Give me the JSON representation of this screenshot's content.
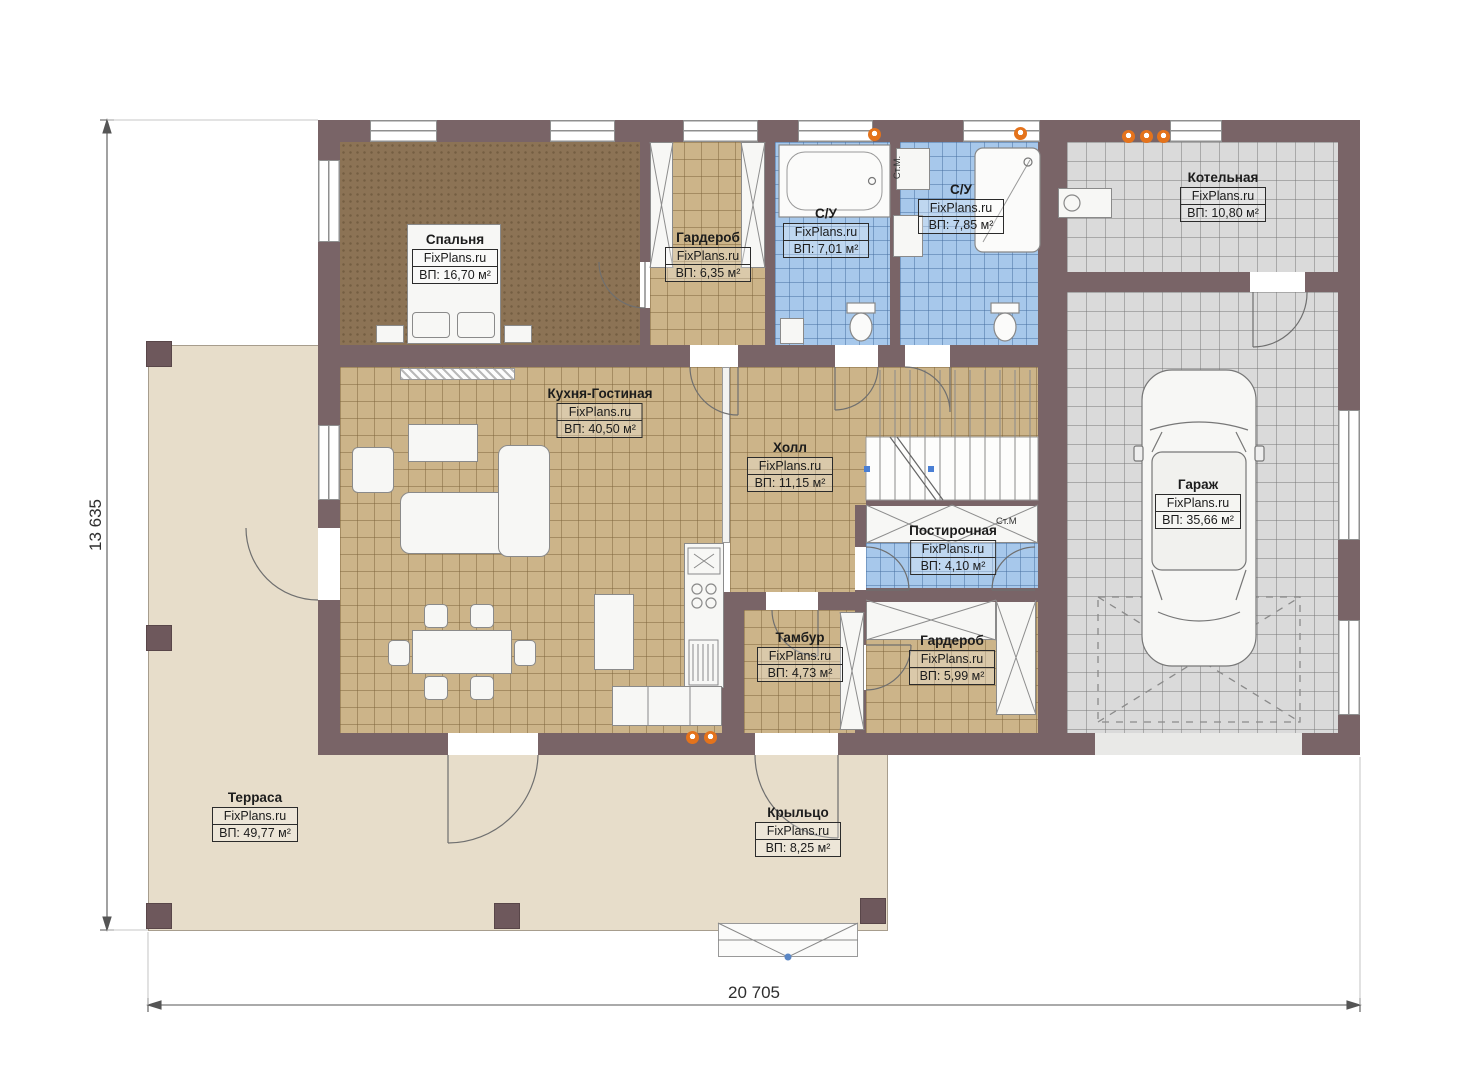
{
  "plan": {
    "brand": "FixPlans.ru",
    "dimensions": {
      "height_label": "13 635",
      "width_label": "20 705"
    },
    "annotations": {
      "washer_vertical": "Ст.М.",
      "washer_laundry": "Ст.М"
    },
    "rooms": [
      {
        "name": "Спальня",
        "area": "ВП: 16,70 м²"
      },
      {
        "name": "Гардероб",
        "area": "ВП: 6,35 м²"
      },
      {
        "name": "С/У",
        "area": "ВП: 7,01 м²"
      },
      {
        "name": "С/У",
        "area": "ВП: 7,85 м²"
      },
      {
        "name": "Котельная",
        "area": "ВП: 10,80 м²"
      },
      {
        "name": "Кухня-Гостиная",
        "area": "ВП: 40,50 м²"
      },
      {
        "name": "Холл",
        "area": "ВП: 11,15 м²"
      },
      {
        "name": "Гараж",
        "area": "ВП: 35,66 м²"
      },
      {
        "name": "Постирочная",
        "area": "ВП: 4,10 м²"
      },
      {
        "name": "Тамбур",
        "area": "ВП: 4,73 м²"
      },
      {
        "name": "Гардероб",
        "area": "ВП: 5,99 м²"
      },
      {
        "name": "Терраса",
        "area": "ВП: 49,77 м²"
      },
      {
        "name": "Крыльцо",
        "area": "ВП: 8,25 м²"
      }
    ]
  }
}
